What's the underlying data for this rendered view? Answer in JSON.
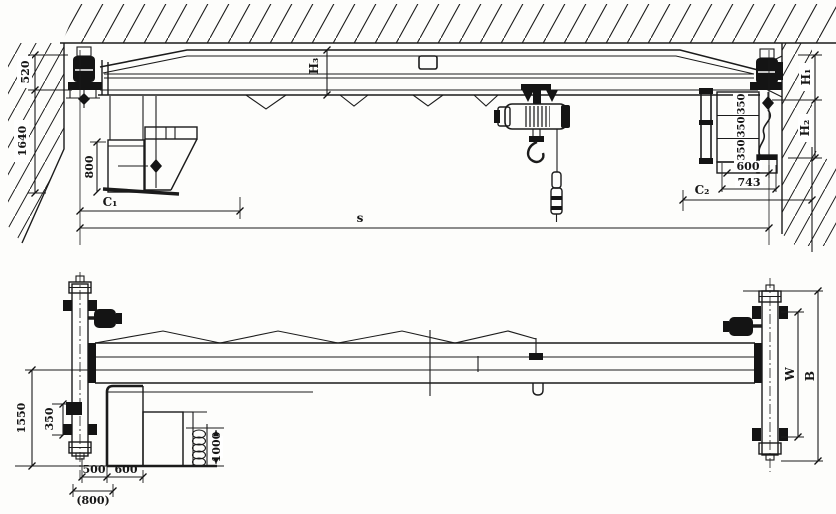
{
  "palette": {
    "ink": "#1b1b1b",
    "paper": "#fdfdfb"
  },
  "elevation": {
    "d520": "520",
    "d1640": "1640",
    "d800": "800",
    "c1": "C₁",
    "s": "s",
    "h3": "H₃",
    "h1": "H₁",
    "h2": "H₂",
    "l350a": "350",
    "l350b": "350",
    "l350c": "350",
    "d600": "600",
    "d743": "743",
    "c2": "C₂"
  },
  "plan": {
    "d1550": "1550",
    "d350": "350",
    "d500": "500",
    "d800_alt": "(800)",
    "d600": "600",
    "d1000": "1000",
    "w": "W",
    "b": "B"
  }
}
